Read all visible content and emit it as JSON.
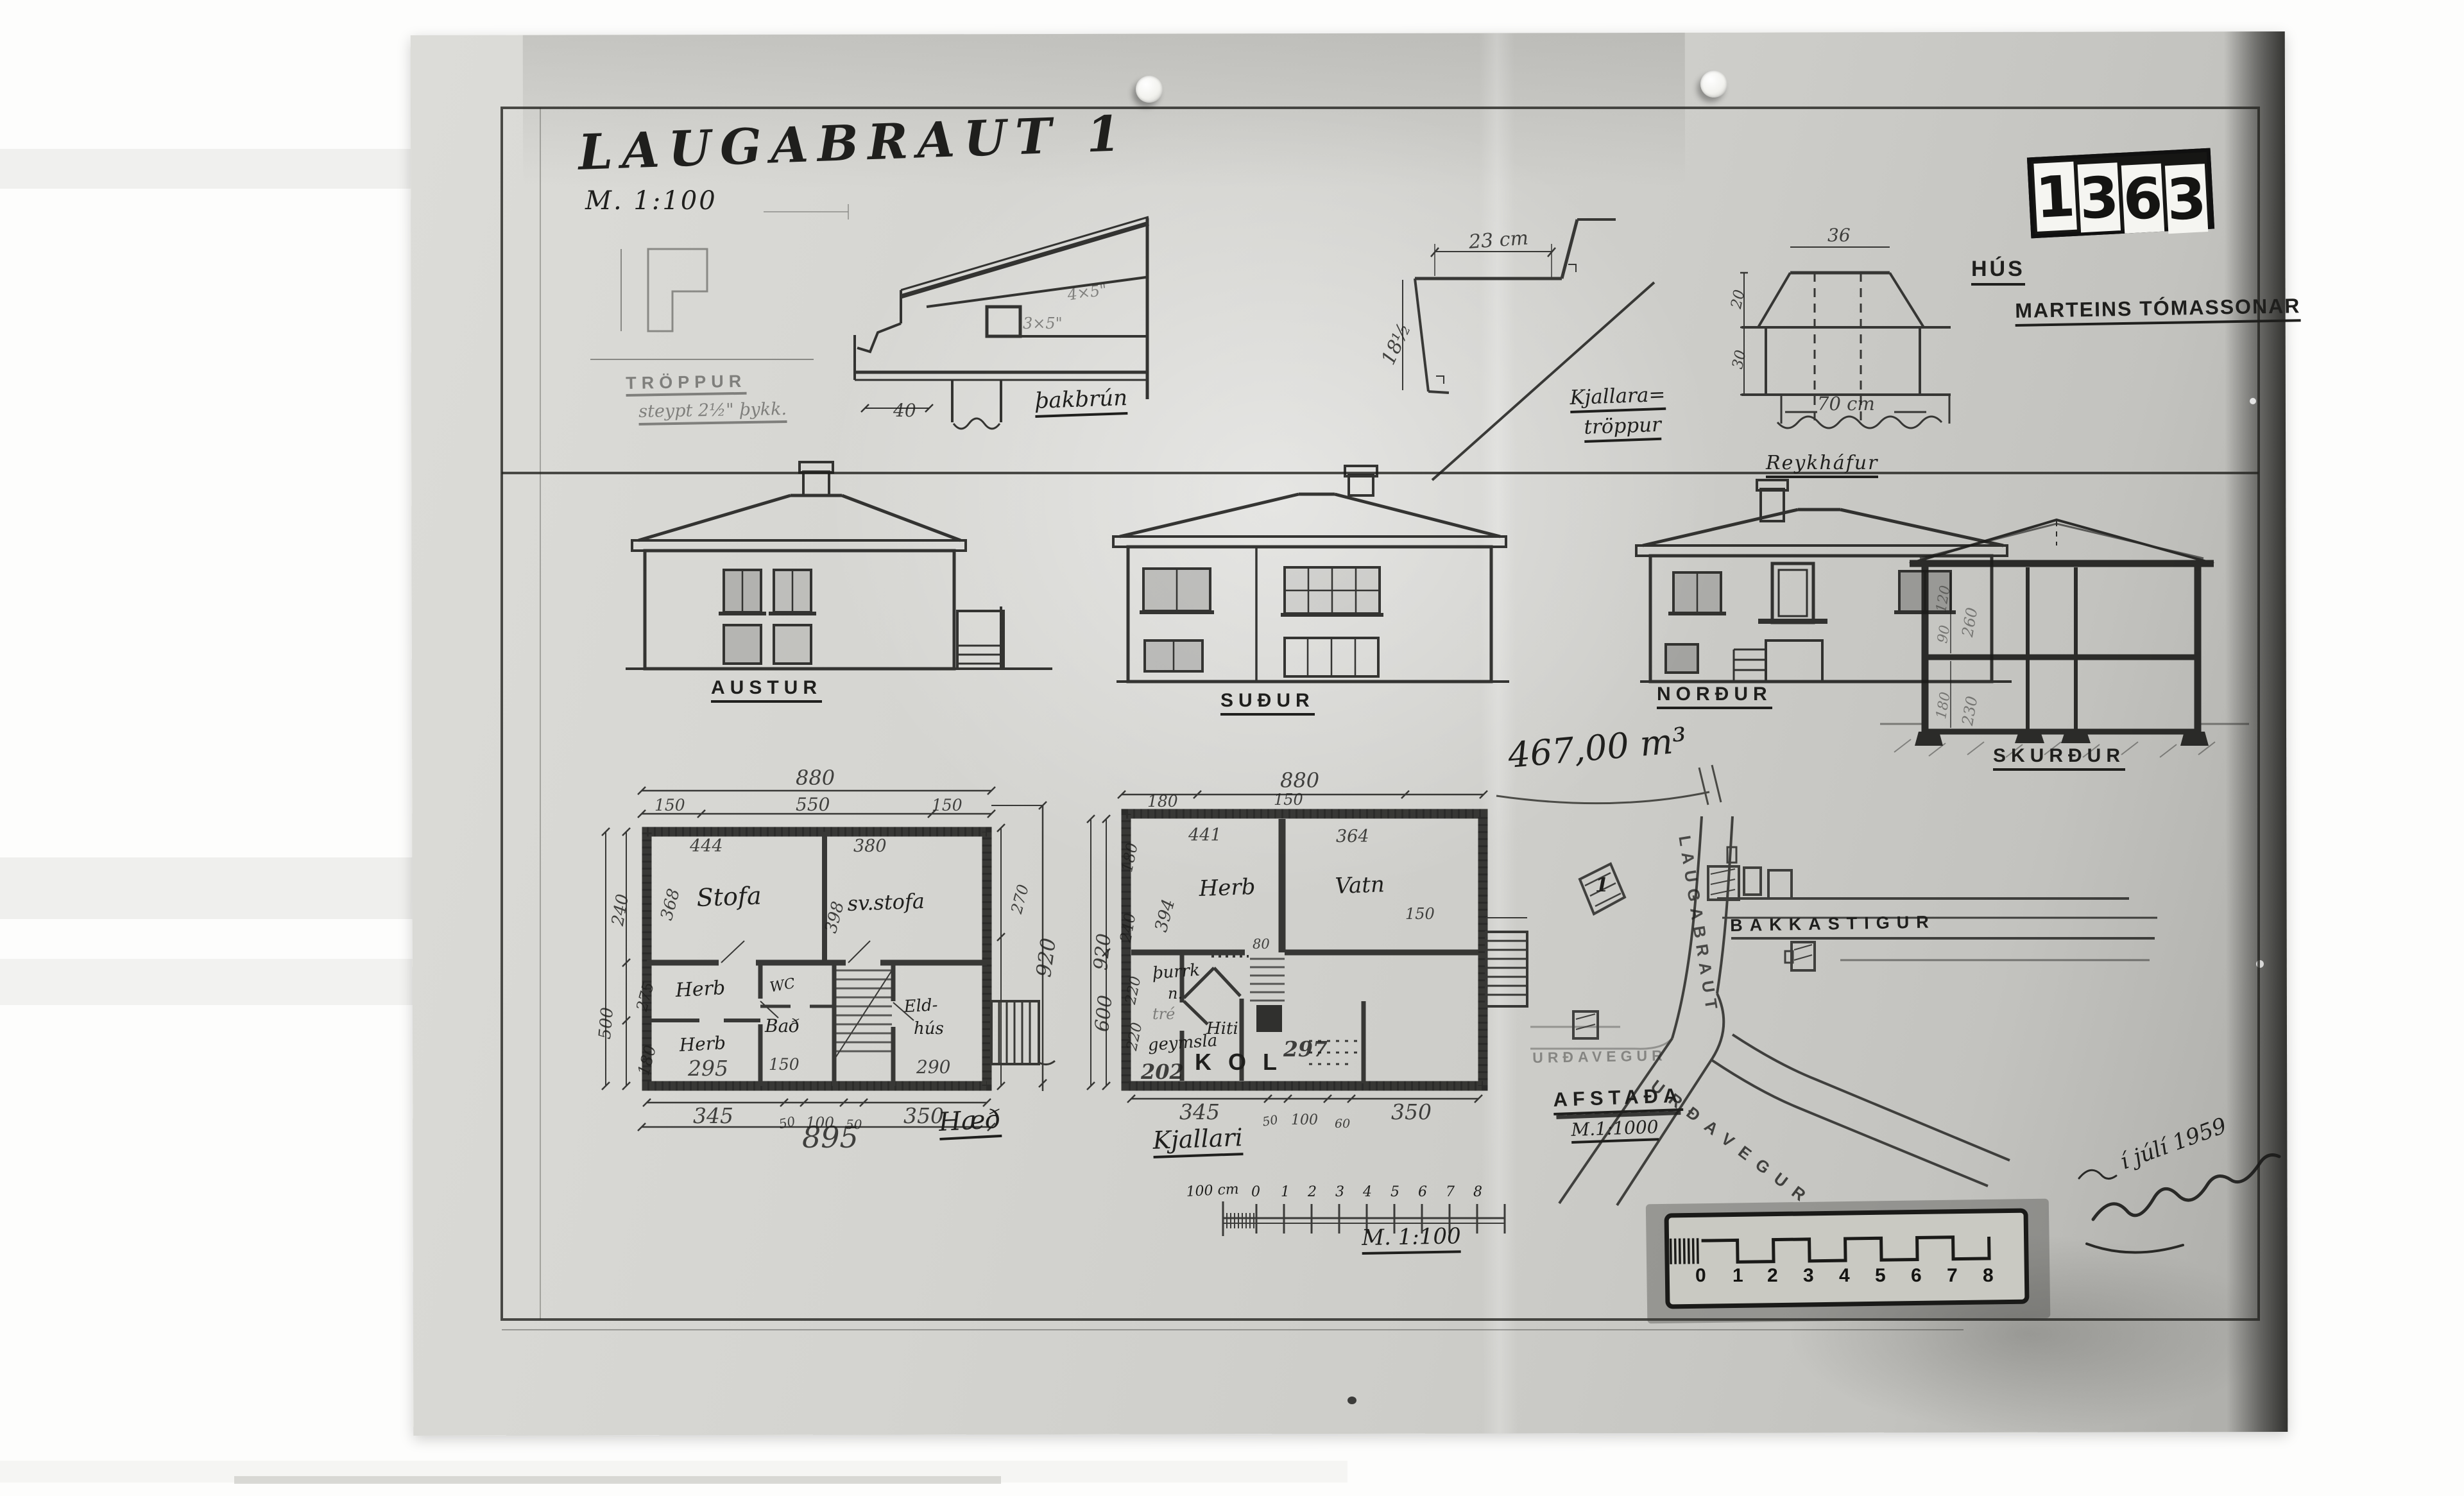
{
  "photo": {
    "archive_number": {
      "digits": [
        "1",
        "3",
        "6",
        "3"
      ]
    },
    "title_block": {
      "title": "LAUGABRAUT 1",
      "scale": "M. 1:100"
    },
    "owner_block": {
      "line1": "HÚS",
      "line2": "MARTEINS TÓMASSONAR"
    },
    "details": {
      "troppur": {
        "label": "TRÖPPUR",
        "note": "steypt 2½\" þykk."
      },
      "step": {
        "width": "23 cm",
        "height": "18½"
      },
      "thakbrun": {
        "label": "þakbrún",
        "dim": "40",
        "note_upper": "4×5\"",
        "note_lower": "3×5\""
      },
      "kjallara_troppur": {
        "line1": "Kjallara=",
        "line2": "tröppur"
      },
      "reykhafur": {
        "label": "Reykháfur",
        "top": "36",
        "bottom": "70 cm",
        "side_upper": "20",
        "side_lower": "30"
      }
    },
    "elevations": {
      "east": "AUSTUR",
      "south": "SUÐUR",
      "north": "NORÐUR",
      "section": "SKURÐUR",
      "section_dims": {
        "d120": "120",
        "d90": "90",
        "d260": "260",
        "d180": "180",
        "d230": "230"
      }
    },
    "plan_main": {
      "label": "Hæð",
      "rooms": {
        "stofa": "Stofa",
        "svstofa": "sv.stofa",
        "herb1": "Herb",
        "herb2": "Herb",
        "wc": "WC",
        "bad": "Bað",
        "eldhus1": "Eld-",
        "eldhus2": "hús"
      },
      "dims": {
        "top_total": "880",
        "top_left": "150",
        "top_mid": "550",
        "top_right": "150",
        "stofa_w": "444",
        "svstofa_w": "380",
        "stofa_h": "368",
        "svstofa_h": "398",
        "left_240": "240",
        "left_500": "500",
        "left_275": "275",
        "left_180": "180",
        "right_270": "270",
        "right_920": "920",
        "herb_w": "295",
        "bad_w": "150",
        "eldhus_w": "290",
        "bottom_345": "345",
        "bottom_50a": "50",
        "bottom_100": "100",
        "bottom_50b": "50",
        "bottom_350": "350",
        "bottom_total": "895"
      }
    },
    "plan_basement": {
      "label": "Kjallari",
      "rooms": {
        "herb": "Herb",
        "vatn": "Vatn",
        "thurrk1": "þurrk",
        "thurrk2": "n.",
        "tre": "tré",
        "geymsla": "geymsla",
        "hiti": "Hiti",
        "kol": "K O L"
      },
      "dims": {
        "top_total": "880",
        "top_left": "180",
        "top_mid": "150",
        "herb_w": "441",
        "vatn_w": "364",
        "herb_h": "394",
        "left_180": "180",
        "left_240": "240",
        "left_920": "920",
        "left_600": "600",
        "left_220a": "220",
        "left_220b": "220",
        "stair_w": "80",
        "stair_150": "150",
        "geymsla_n": "202",
        "room_297": "297",
        "bottom_345": "345",
        "bottom_50": "50",
        "bottom_100": "100",
        "bottom_60": "60",
        "bottom_350": "350"
      }
    },
    "volume_note": "467,00 m³",
    "site_plan": {
      "street_vertical": "LAUGABRAUT",
      "plot_number": "1",
      "street_east": "BAKKASTIGUR",
      "street_west": "URÐAVEGUR",
      "street_diagonal": "URÐAVEGUR",
      "caption": "AFSTAÐA",
      "caption_scale": "M.1:1000"
    },
    "scale_bar": {
      "pre_label": "100 cm",
      "ticks": [
        "0",
        "1",
        "2",
        "3",
        "4",
        "5",
        "6",
        "7",
        "8"
      ],
      "caption": "M. 1:100"
    },
    "photo_ruler": {
      "numbers": [
        "0",
        "1",
        "2",
        "3",
        "4",
        "5",
        "6",
        "7",
        "8"
      ]
    },
    "signature": {
      "date": "í júlí 1959"
    }
  }
}
